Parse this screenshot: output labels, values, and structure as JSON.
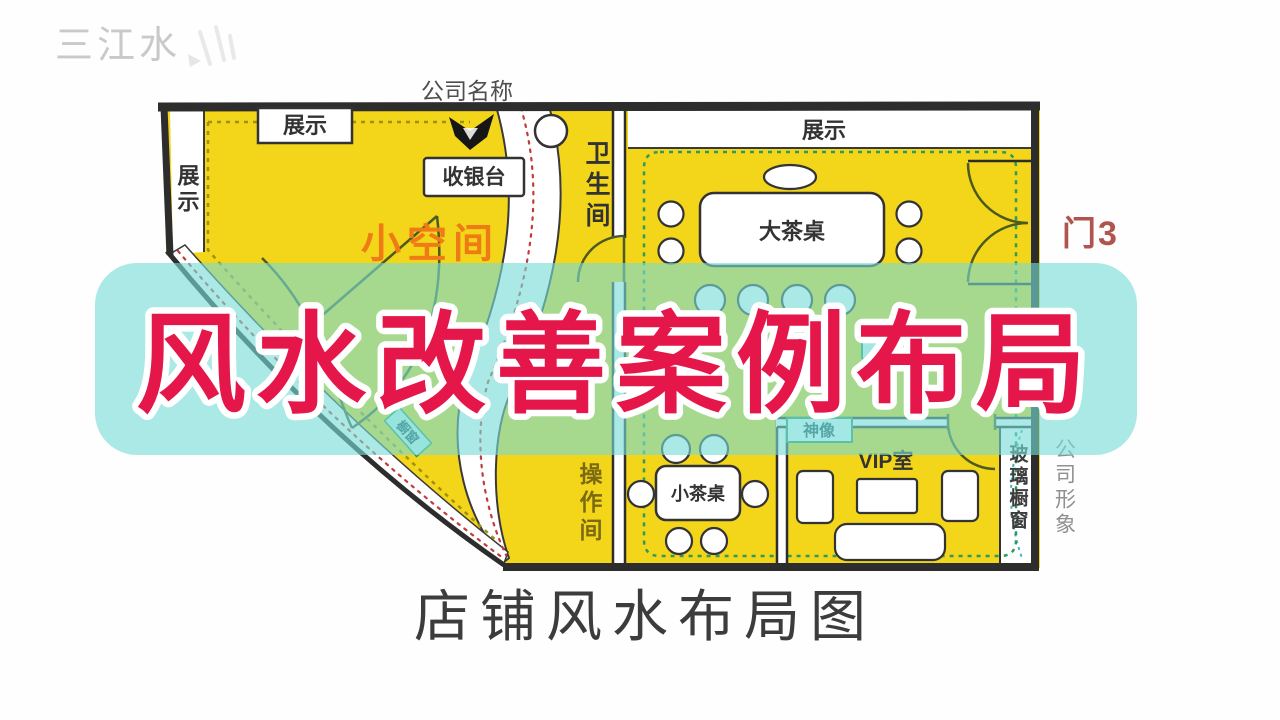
{
  "watermark": {
    "brand": "三江水"
  },
  "overlay": {
    "title": "风水改善案例布局",
    "title_color": "#e4164a",
    "band_color": "#76dcd6"
  },
  "caption": "店铺风水布局图",
  "plan": {
    "outside": {
      "company_name": "公司名称",
      "door3": "门3",
      "company_image": "公司形象"
    },
    "left_section": {
      "display_strip": "展示",
      "display_box": "展示",
      "cashier": "收银台",
      "small_space": "小空间",
      "bathroom": "卫生间",
      "operation_room": "操作间",
      "window_tag": "橱窗"
    },
    "right_section": {
      "display_strip": "展示",
      "big_tea_table": "大茶桌",
      "small_tea_table": "小茶桌",
      "vip_room": "VIP室",
      "deity": "神像",
      "glass_window": "玻璃橱窗"
    }
  },
  "colors": {
    "room_yellow": "#f3d519",
    "wall": "#2d2d2d",
    "zone_dash_left": "#a08f10",
    "zone_dash_right": "#2f9a5f",
    "corridor_dots": "#c23b3b",
    "small_space_orange": "#ee7b16",
    "door3_red": "#b0544d"
  }
}
